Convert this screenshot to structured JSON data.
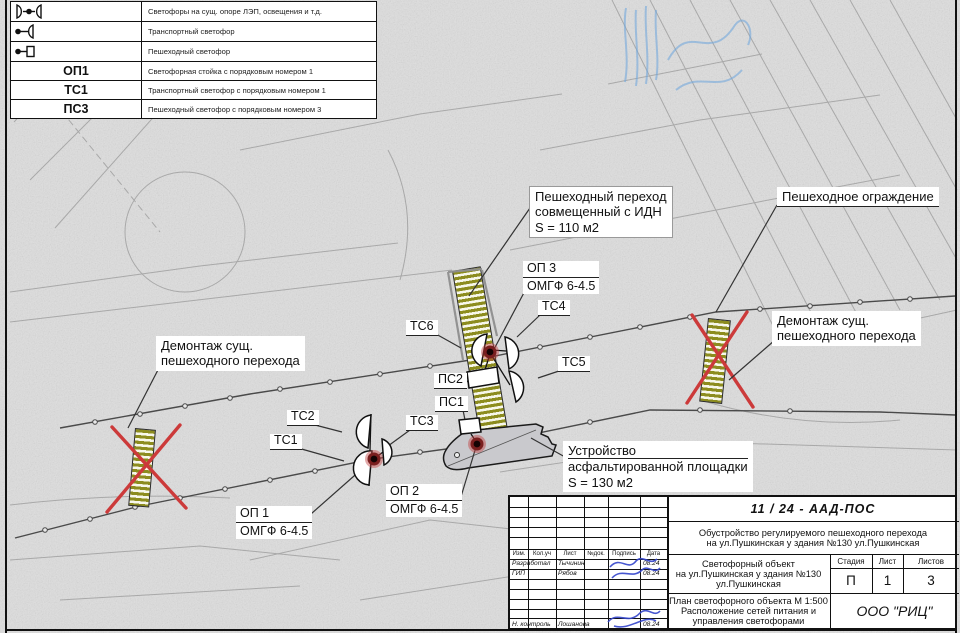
{
  "colors": {
    "accent_red": "#cc3a3a",
    "stripe_olive": "#8c8c1e",
    "signature_blue": "#3344cc",
    "stamp_blue": "#74a9dd",
    "asphalt_gray": "#c9c9cd"
  },
  "legend": {
    "rows": [
      {
        "symbol": "dual-transport-signal-icon",
        "label": "Светофоры на сущ. опоре ЛЭП, освещения и т.д."
      },
      {
        "symbol": "transport-signal-icon",
        "label": "Транспортный светофор"
      },
      {
        "symbol": "pedestrian-signal-icon",
        "label": "Пешеходный светофор"
      },
      {
        "symbol": "ОП1",
        "label": "Светофорная стойка с порядковым номером 1"
      },
      {
        "symbol": "ТС1",
        "label": "Транспортный светофор с порядковым номером 1"
      },
      {
        "symbol": "ПС3",
        "label": "Пешеходный светофор с порядковым номером 3"
      }
    ]
  },
  "callouts": {
    "ped_crossing": {
      "l1": "Пешеходный переход",
      "l2": "совмещенный с ИДН",
      "l3": "S = 110 м2"
    },
    "fence": "Пешеходное ограждение",
    "demolish_left": {
      "l1": "Демонтаж сущ.",
      "l2": "пешеходного перехода"
    },
    "demolish_right": {
      "l1": "Демонтаж сущ.",
      "l2": "пешеходного перехода"
    },
    "asphalt": {
      "l1": "Устройство",
      "l2": "асфальтированной площадки",
      "l3": "S = 130 м2"
    },
    "op3": {
      "top": "ОП 3",
      "bottom": "ОМГФ  6-4.5"
    },
    "op2": {
      "top": "ОП 2",
      "bottom": "ОМГФ 6-4.5"
    },
    "op1": {
      "top": "ОП 1",
      "bottom": "ОМГФ 6-4.5"
    },
    "tc1": "ТС1",
    "tc2": "ТС2",
    "tc3": "ТС3",
    "tc4": "ТС4",
    "tc5": "ТС5",
    "tc6": "ТС6",
    "ps1": "ПС1",
    "ps2": "ПС2"
  },
  "titleblock": {
    "doc_number": "11 / 24 - ААД-ПОС",
    "project_line1": "Обустройство регулируемого пешеходного перехода",
    "project_line2": "на ул.Пушкинская у здания №130 ул.Пушкинская",
    "columns": {
      "izm": "Изм.",
      "koluch": "Кол.уч",
      "list": "Лист",
      "ndok": "№док.",
      "podpis": "Подпись",
      "data": "Дата"
    },
    "row_developed": {
      "role": "Разработал",
      "name": "Тычинин",
      "date": "08.24"
    },
    "row_gip": {
      "role": "ГИП",
      "name": "Рябов",
      "date": "08.24"
    },
    "row_ncontrol": {
      "role": "Н. контроль",
      "name": "Лошанова",
      "date": "08.24"
    },
    "object_line1": "Светофорный объект",
    "object_line2": "на ул.Пушкинская у здания №130",
    "object_line3": "ул.Пушкинская",
    "stage_label": "Стадия",
    "sheet_label": "Лист",
    "sheets_label": "Листов",
    "stage_value": "П",
    "sheet_value": "1",
    "sheets_value": "3",
    "plan_line1": "План светофорного объекта М 1:500",
    "plan_line2": "Расположение сетей питания и",
    "plan_line3": "управления светофорами",
    "company": "ООО   \"РИЦ\""
  }
}
